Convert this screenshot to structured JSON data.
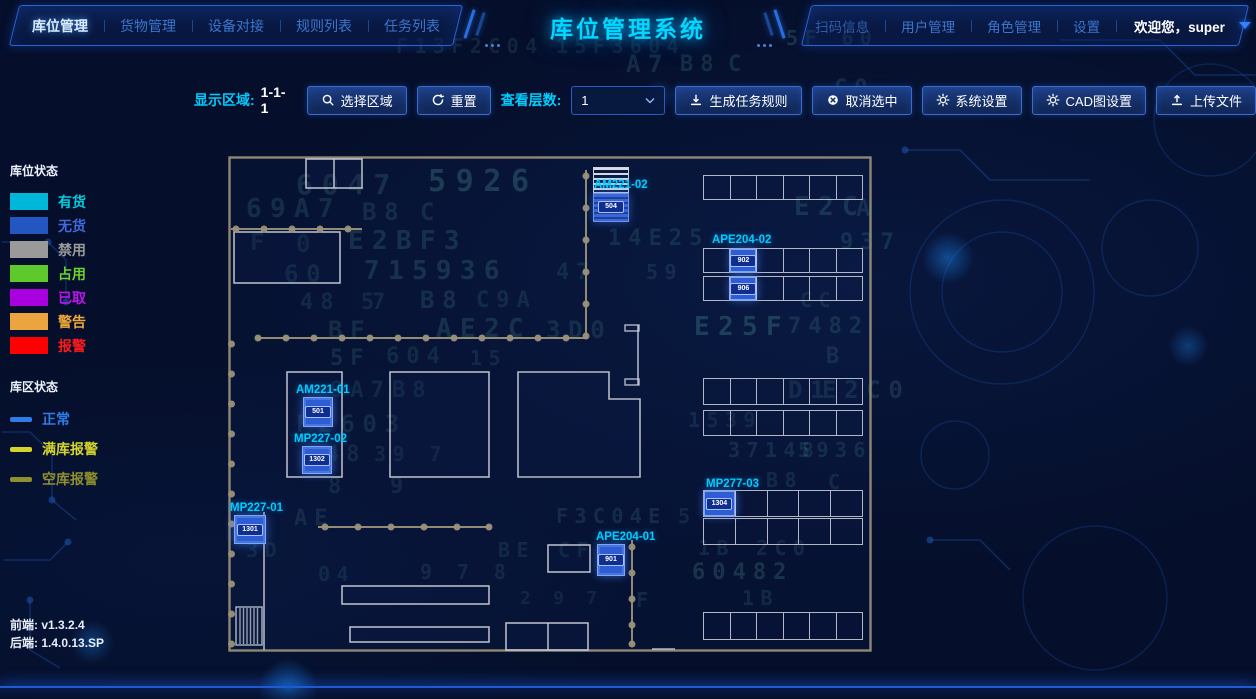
{
  "app": {
    "title": "库位管理系统"
  },
  "header": {
    "left_nav": [
      {
        "label": "库位管理",
        "active": true
      },
      {
        "label": "货物管理"
      },
      {
        "label": "设备对接"
      },
      {
        "label": "规则列表"
      },
      {
        "label": "任务列表"
      }
    ],
    "right_nav": [
      {
        "label": "扫码信息"
      },
      {
        "label": "用户管理"
      },
      {
        "label": "角色管理"
      },
      {
        "label": "设置"
      }
    ],
    "welcome": "欢迎您，super"
  },
  "toolbar": {
    "display_area_label": "显示区域:",
    "display_area_value": "1-1-1",
    "select_region": "选择区域",
    "reset": "重置",
    "view_layers_label": "查看层数:",
    "view_layers_value": "1",
    "generate_rules": "生成任务规则",
    "cancel_selection": "取消选中",
    "system_settings": "系统设置",
    "cad_settings": "CAD图设置",
    "upload_file": "上传文件"
  },
  "legend": {
    "slot_status_title": "库位状态",
    "slot_items": [
      {
        "label": "有货",
        "color": "#00b6d9",
        "text_color": "#00cfe0"
      },
      {
        "label": "无货",
        "color": "#2356c0",
        "text_color": "#3f6ae0"
      },
      {
        "label": "禁用",
        "color": "#9a9a9a",
        "text_color": "#9a9a9a"
      },
      {
        "label": "占用",
        "color": "#5fc82d",
        "text_color": "#6ed02e"
      },
      {
        "label": "已取",
        "color": "#aa00e0",
        "text_color": "#bb16ee"
      },
      {
        "label": "警告",
        "color": "#eca440",
        "text_color": "#eda73a"
      },
      {
        "label": "报警",
        "color": "#ff0000",
        "text_color": "#ff1a1a"
      }
    ],
    "area_status_title": "库区状态",
    "area_items": [
      {
        "label": "正常",
        "color": "#2d7ce8",
        "text_color": "#2d7ce8"
      },
      {
        "label": "满库报警",
        "color": "#d4d42a",
        "text_color": "#d4d42a"
      },
      {
        "label": "空库报警",
        "color": "#8f8f2e",
        "text_color": "#8f8f2e"
      }
    ]
  },
  "versions": {
    "frontend_label": "前端:",
    "frontend": "v1.3.2.4",
    "backend_label": "后端:",
    "backend": "1.4.0.13.SP"
  },
  "colors": {
    "accent_blue": "#2d6fe8",
    "title_cyan": "#00d8ff",
    "label_cyan": "#00ccff",
    "cell_blue": "#2e5cd2",
    "wall_tan": "#9a9179",
    "grid_white": "#cdd1da",
    "bg": "#050f2b"
  },
  "map": {
    "racks": [
      {
        "name": "rack-top-right",
        "x": 475,
        "y": 19,
        "w": 160,
        "h": 25,
        "rows": 1,
        "cols": 6,
        "row_gap": 0,
        "selected": []
      },
      {
        "name": "rack-APE204-02",
        "x": 475,
        "y": 92,
        "w": 160,
        "h": 53,
        "rows": 2,
        "cols": 6,
        "row_gap": 3,
        "selected": [
          {
            "r": 0,
            "c": 1,
            "badge": "902"
          },
          {
            "r": 1,
            "c": 1,
            "badge": "906"
          }
        ]
      },
      {
        "name": "rack-right-middle",
        "x": 475,
        "y": 222,
        "w": 160,
        "h": 58,
        "rows": 2,
        "cols": 6,
        "row_gap": 5,
        "selected": []
      },
      {
        "name": "rack-MP277-03",
        "x": 475,
        "y": 334,
        "w": 160,
        "h": 55,
        "rows": 2,
        "cols": 5,
        "row_gap": 1,
        "selected": [
          {
            "r": 0,
            "c": 0,
            "badge": "1304"
          }
        ]
      },
      {
        "name": "rack-bottom-right",
        "x": 475,
        "y": 456,
        "w": 160,
        "h": 28,
        "rows": 1,
        "cols": 6,
        "row_gap": 0,
        "selected": []
      }
    ],
    "zones": [
      {
        "id": "AM221-02",
        "label_x": 366,
        "label_y": 23,
        "type": "striped",
        "cell": {
          "x": 365,
          "y": 11,
          "w": 36,
          "h": 55,
          "badge": "504"
        }
      },
      {
        "id": "APE204-02",
        "label_x": 484,
        "label_y": 78
      },
      {
        "id": "AM221-01",
        "label_x": 68,
        "label_y": 228,
        "cell": {
          "x": 75,
          "y": 241,
          "w": 30,
          "h": 30,
          "badge": "501"
        }
      },
      {
        "id": "MP227-02",
        "label_x": 66,
        "label_y": 277,
        "cell": {
          "x": 74,
          "y": 290,
          "w": 30,
          "h": 28,
          "badge": "1302"
        }
      },
      {
        "id": "MP227-01",
        "label_x": 2,
        "label_y": 346,
        "cell": {
          "x": 6,
          "y": 359,
          "w": 32,
          "h": 29,
          "badge": "1301"
        }
      },
      {
        "id": "MP277-03",
        "label_x": 478,
        "label_y": 322
      },
      {
        "id": "APE204-01",
        "label_x": 368,
        "label_y": 375,
        "cell": {
          "x": 369,
          "y": 388,
          "w": 28,
          "h": 32,
          "badge": "901"
        }
      }
    ]
  },
  "decor": {
    "strings": [
      {
        "t": "A7",
        "x": 626,
        "y": 50,
        "s": 24,
        "o": 0.13
      },
      {
        "t": "B8",
        "x": 680,
        "y": 52,
        "s": 22,
        "o": 0.13
      },
      {
        "t": "C",
        "x": 728,
        "y": 52,
        "s": 22,
        "o": 0.13
      },
      {
        "t": "F13F2C04",
        "x": 396,
        "y": 34,
        "s": 20,
        "o": 0.1
      },
      {
        "t": "15F3604",
        "x": 556,
        "y": 34,
        "s": 20,
        "o": 0.09
      },
      {
        "t": "5F 60",
        "x": 786,
        "y": 26,
        "s": 20,
        "o": 0.16
      },
      {
        "t": "C0",
        "x": 834,
        "y": 76,
        "s": 22,
        "o": 0.12
      },
      {
        "t": "593",
        "x": 742,
        "y": 96,
        "s": 20,
        "o": 0.12
      },
      {
        "t": "6047",
        "x": 296,
        "y": 168,
        "s": 28,
        "o": 0.14
      },
      {
        "t": "5926",
        "x": 428,
        "y": 164,
        "s": 30,
        "o": 0.2
      },
      {
        "t": "69A7",
        "x": 246,
        "y": 194,
        "s": 26,
        "o": 0.13
      },
      {
        "t": "B8",
        "x": 362,
        "y": 198,
        "s": 24,
        "o": 0.12
      },
      {
        "t": "C",
        "x": 420,
        "y": 198,
        "s": 24,
        "o": 0.12
      },
      {
        "t": "E2C",
        "x": 794,
        "y": 192,
        "s": 26,
        "o": 0.15
      },
      {
        "t": "A",
        "x": 856,
        "y": 194,
        "s": 24,
        "o": 0.12
      },
      {
        "t": "F",
        "x": 250,
        "y": 228,
        "s": 24,
        "o": 0.11
      },
      {
        "t": "0",
        "x": 296,
        "y": 230,
        "s": 24,
        "o": 0.11
      },
      {
        "t": "E2BF3",
        "x": 348,
        "y": 226,
        "s": 26,
        "o": 0.14
      },
      {
        "t": "14E25",
        "x": 608,
        "y": 226,
        "s": 22,
        "o": 0.12
      },
      {
        "t": "937",
        "x": 840,
        "y": 230,
        "s": 22,
        "o": 0.13
      },
      {
        "t": "60",
        "x": 284,
        "y": 260,
        "s": 24,
        "o": 0.12
      },
      {
        "t": "715936",
        "x": 364,
        "y": 256,
        "s": 26,
        "o": 0.15
      },
      {
        "t": "47",
        "x": 556,
        "y": 260,
        "s": 22,
        "o": 0.11
      },
      {
        "t": "59",
        "x": 646,
        "y": 260,
        "s": 20,
        "o": 0.11
      },
      {
        "t": "48 5",
        "x": 300,
        "y": 290,
        "s": 22,
        "o": 0.11
      },
      {
        "t": "7",
        "x": 372,
        "y": 290,
        "s": 22,
        "o": 0.11
      },
      {
        "t": "B8",
        "x": 420,
        "y": 286,
        "s": 24,
        "o": 0.13
      },
      {
        "t": "C9A",
        "x": 476,
        "y": 288,
        "s": 22,
        "o": 0.11
      },
      {
        "t": "CC",
        "x": 800,
        "y": 288,
        "s": 20,
        "o": 0.11
      },
      {
        "t": "BF",
        "x": 328,
        "y": 316,
        "s": 24,
        "o": 0.12
      },
      {
        "t": "AE2C",
        "x": 436,
        "y": 314,
        "s": 26,
        "o": 0.14
      },
      {
        "t": "3D0",
        "x": 546,
        "y": 316,
        "s": 24,
        "o": 0.12
      },
      {
        "t": "E25F",
        "x": 694,
        "y": 312,
        "s": 26,
        "o": 0.2
      },
      {
        "t": "7482",
        "x": 788,
        "y": 314,
        "s": 22,
        "o": 0.13
      },
      {
        "t": "5F",
        "x": 330,
        "y": 346,
        "s": 22,
        "o": 0.12
      },
      {
        "t": "604",
        "x": 386,
        "y": 344,
        "s": 22,
        "o": 0.11
      },
      {
        "t": "15",
        "x": 470,
        "y": 346,
        "s": 20,
        "o": 0.1
      },
      {
        "t": "B",
        "x": 826,
        "y": 344,
        "s": 22,
        "o": 0.12
      },
      {
        "t": "9A7",
        "x": 330,
        "y": 378,
        "s": 22,
        "o": 0.11
      },
      {
        "t": "B8",
        "x": 392,
        "y": 378,
        "s": 22,
        "o": 0.11
      },
      {
        "t": "D1",
        "x": 788,
        "y": 376,
        "s": 24,
        "o": 0.13
      },
      {
        "t": "E2C0",
        "x": 822,
        "y": 376,
        "s": 24,
        "o": 0.13
      },
      {
        "t": "F2603",
        "x": 296,
        "y": 410,
        "s": 24,
        "o": 0.12
      },
      {
        "t": "1539",
        "x": 688,
        "y": 408,
        "s": 20,
        "o": 0.11
      },
      {
        "t": "48",
        "x": 326,
        "y": 442,
        "s": 22,
        "o": 0.11
      },
      {
        "t": "39 7",
        "x": 374,
        "y": 442,
        "s": 20,
        "o": 0.1
      },
      {
        "t": "37148",
        "x": 728,
        "y": 438,
        "s": 20,
        "o": 0.12
      },
      {
        "t": "5936",
        "x": 798,
        "y": 438,
        "s": 20,
        "o": 0.12
      },
      {
        "t": "8",
        "x": 328,
        "y": 474,
        "s": 22,
        "o": 0.1
      },
      {
        "t": "9",
        "x": 390,
        "y": 474,
        "s": 22,
        "o": 0.1
      },
      {
        "t": "B8",
        "x": 766,
        "y": 468,
        "s": 20,
        "o": 0.11
      },
      {
        "t": "C",
        "x": 828,
        "y": 470,
        "s": 20,
        "o": 0.11
      },
      {
        "t": "AE",
        "x": 294,
        "y": 506,
        "s": 22,
        "o": 0.11
      },
      {
        "t": "F3C04E",
        "x": 556,
        "y": 504,
        "s": 20,
        "o": 0.12
      },
      {
        "t": "5",
        "x": 678,
        "y": 504,
        "s": 20,
        "o": 0.1
      },
      {
        "t": "3D",
        "x": 246,
        "y": 538,
        "s": 20,
        "o": 0.1
      },
      {
        "t": "BE",
        "x": 498,
        "y": 538,
        "s": 20,
        "o": 0.1
      },
      {
        "t": "CF",
        "x": 558,
        "y": 538,
        "s": 20,
        "o": 0.11
      },
      {
        "t": "1B",
        "x": 698,
        "y": 536,
        "s": 20,
        "o": 0.11
      },
      {
        "t": "2C0",
        "x": 756,
        "y": 536,
        "s": 20,
        "o": 0.11
      },
      {
        "t": "04",
        "x": 318,
        "y": 562,
        "s": 20,
        "o": 0.1
      },
      {
        "t": "9 7 8",
        "x": 420,
        "y": 560,
        "s": 20,
        "o": 0.1
      },
      {
        "t": "60482",
        "x": 692,
        "y": 560,
        "s": 22,
        "o": 0.16
      },
      {
        "t": "F",
        "x": 636,
        "y": 588,
        "s": 20,
        "o": 0.11
      },
      {
        "t": "1B",
        "x": 742,
        "y": 586,
        "s": 20,
        "o": 0.11
      },
      {
        "t": "2 9 7",
        "x": 520,
        "y": 588,
        "s": 18,
        "o": 0.09
      }
    ]
  }
}
